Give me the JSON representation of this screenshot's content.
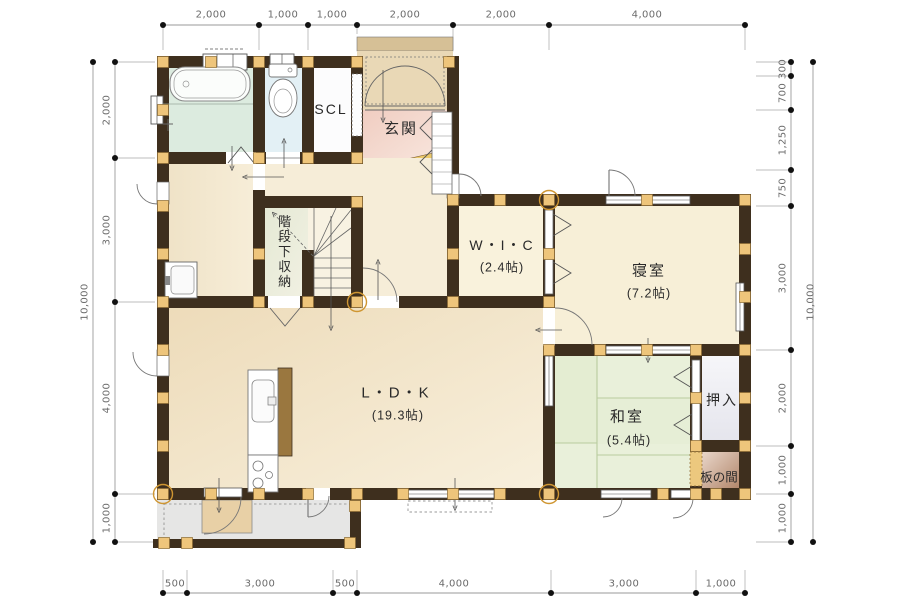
{
  "plan": {
    "title": "1F floor plan",
    "rooms": {
      "scl": {
        "label": "SCL"
      },
      "genkan": {
        "label": "玄関"
      },
      "stair_storage": {
        "label": "階段下収納"
      },
      "wic": {
        "label": "W・I・C",
        "size": "(2.4帖)"
      },
      "bedroom": {
        "label": "寝室",
        "size": "(7.2帖)"
      },
      "ldk": {
        "label": "L・D・K",
        "size": "(19.3帖)"
      },
      "washitsu": {
        "label": "和室",
        "size": "(5.4帖)"
      },
      "oshiire": {
        "label": "押入"
      },
      "itanoma": {
        "label": "板の間"
      }
    },
    "dims": {
      "top": [
        "2,000",
        "1,000",
        "1,000",
        "2,000",
        "2,000",
        "4,000"
      ],
      "bottom": [
        "500",
        "3,000",
        "500",
        "4,000",
        "3,000",
        "1,000"
      ],
      "left": [
        "2,000",
        "3,000",
        "4,000",
        "1,000"
      ],
      "left_total": "10,000",
      "right": [
        "300",
        "700",
        "1,250",
        "750",
        "3,000",
        "2,000",
        "1,000",
        "1,000"
      ],
      "right_total": "10,000"
    },
    "colors": {
      "wall": "#3e2f1e",
      "post": "#eec57b",
      "bath_floor": "#dcebdf",
      "toilet_floor": "#e3f0f5",
      "genkan_floor": "#f2d3c8",
      "wood_floor": "#f1e1c2",
      "tatami": "#e9f0da",
      "itanoma": "#aa7c5e",
      "deck": "#e6e6e5",
      "step": "#ecc96a"
    }
  }
}
